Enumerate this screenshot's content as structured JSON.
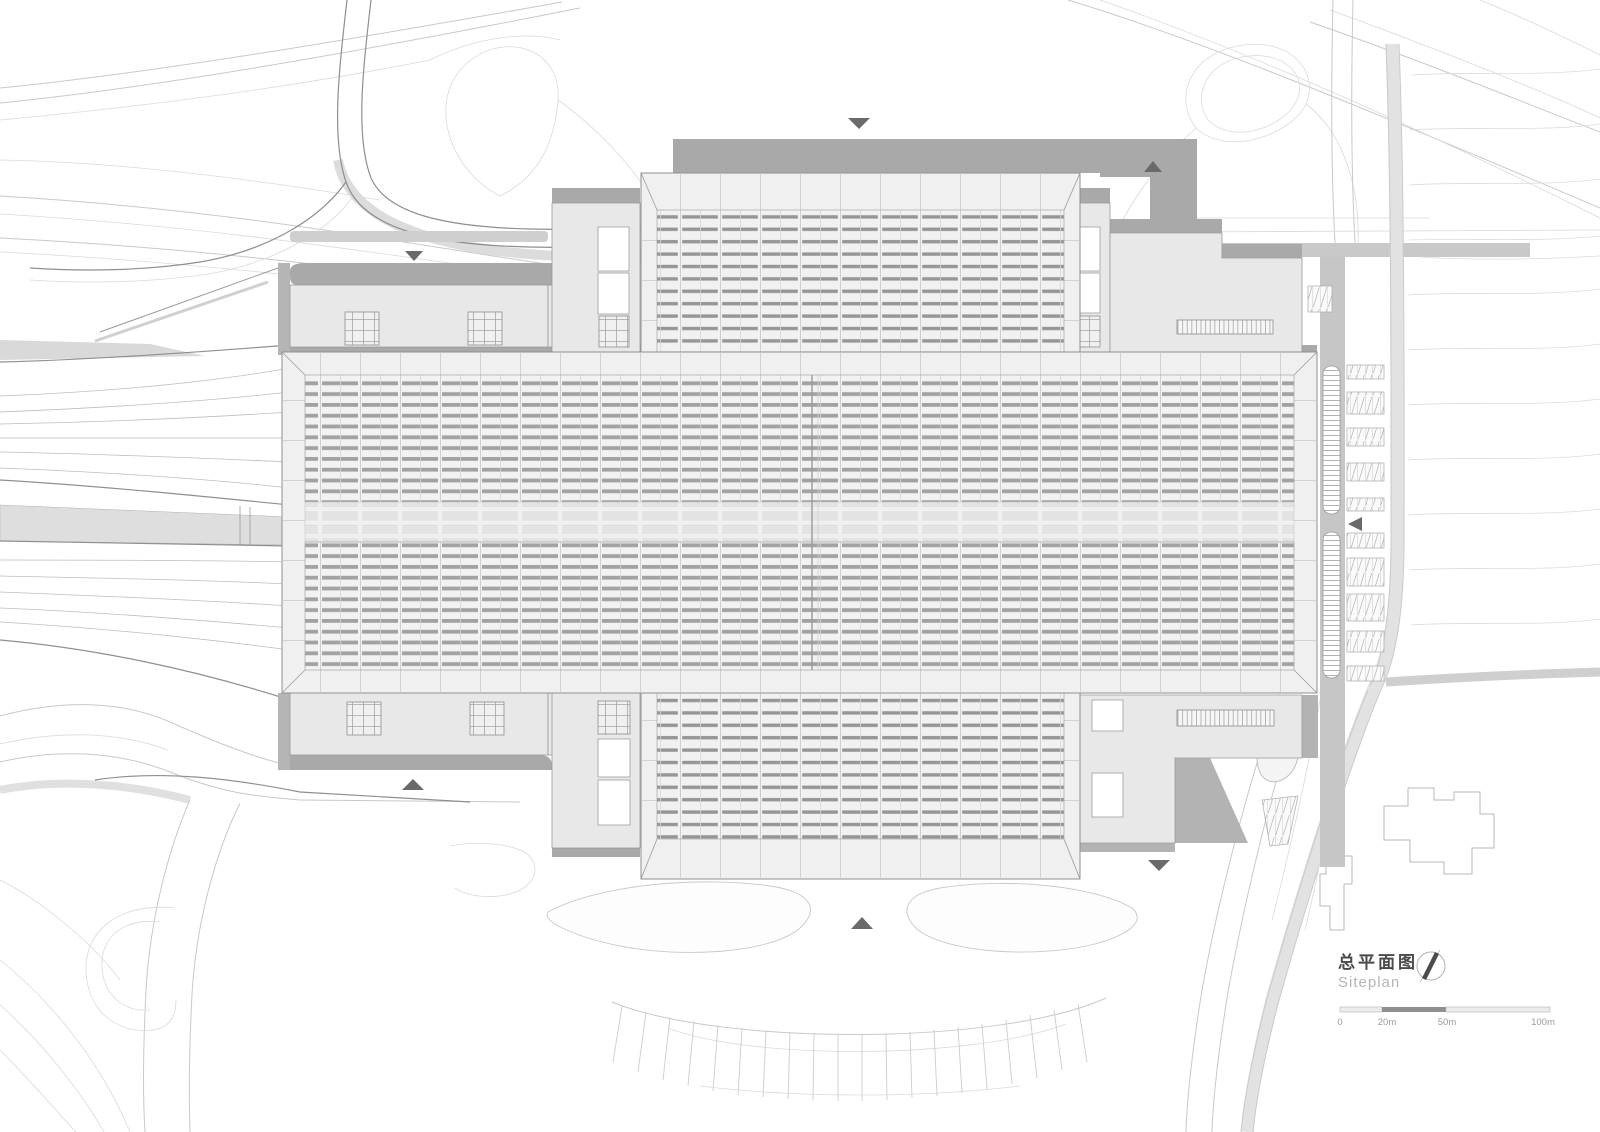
{
  "page": {
    "type": "architectural-site-plan",
    "background": "#ffffff",
    "subject": "railway-station-roof-plan"
  },
  "title_block": {
    "title_primary": "总平面图",
    "title_secondary": "Siteplan"
  },
  "scale_bar": {
    "labels": {
      "zero": "0",
      "twenty": "20m",
      "fifty": "50m",
      "hundred": "100m"
    },
    "dark_segment": "20m-50m"
  },
  "north_arrow": {
    "style": "circle-with-needle"
  },
  "entry_markers": [
    {
      "id": "north-entry",
      "direction": "down"
    },
    {
      "id": "northeast-entry",
      "direction": "up"
    },
    {
      "id": "west-entry",
      "direction": "down"
    },
    {
      "id": "east-parking-entry",
      "direction": "left"
    },
    {
      "id": "south-plaza-entry",
      "direction": "up"
    },
    {
      "id": "southwest-entry",
      "direction": "up"
    },
    {
      "id": "southeast-entry",
      "direction": "down"
    }
  ],
  "colors": {
    "roof_louver": "#a2a2a2",
    "building_fill": "#e8e8e8",
    "frame_fill": "#f0f0f0",
    "shadow": "#a9a9a9",
    "road_line": "#c9c9c9",
    "railway_line": "#bdbdbd",
    "marker": "#6a6a6a",
    "title_primary_color": "#4a4a4a",
    "title_secondary_color": "#b5b5b5",
    "scale_dark": "#8f8f8f"
  }
}
